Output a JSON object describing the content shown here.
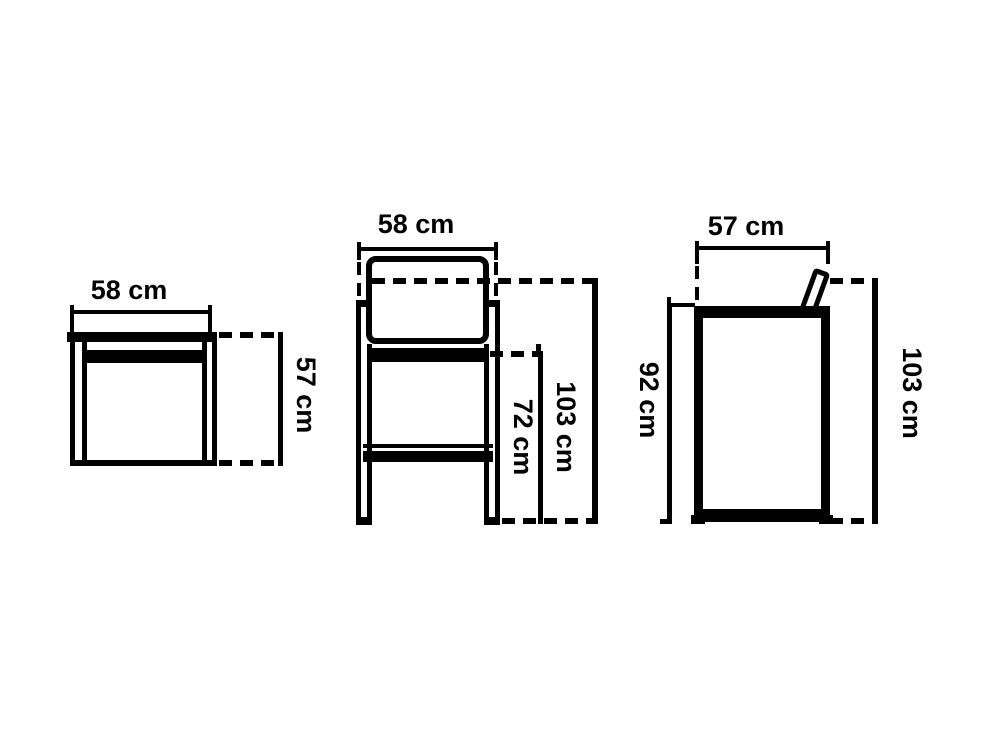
{
  "background_color": "#ffffff",
  "line_color": "#000000",
  "unit": "cm",
  "figures": {
    "side_table_front": {
      "width_label": "58 cm",
      "height_label": "57 cm"
    },
    "bar_stool_front": {
      "width_label": "58 cm",
      "seat_height_label": "72 cm",
      "overall_height_label": "103 cm"
    },
    "bar_stool_side": {
      "depth_label": "57 cm",
      "seat_back_height_label": "92 cm",
      "overall_height_label": "103 cm"
    }
  }
}
